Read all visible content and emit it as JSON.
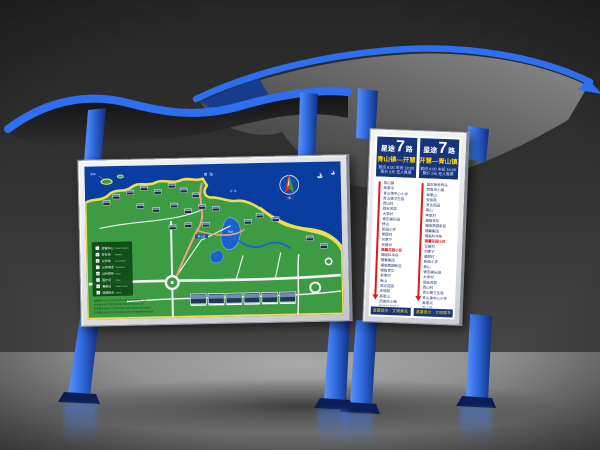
{
  "scene": {
    "accent_blue": "#2e6ff2",
    "post_blue_dark": "#14338c",
    "panel_frame": "#e2e4e8",
    "header_navy": "#17357d",
    "highlight_red": "#e01818",
    "direction_yellow": "#ffd400"
  },
  "map_panel": {
    "sea_label_1": "黄海",
    "sea_label_2": "近海",
    "island_label": "鸥岛",
    "lake_label": "西湖",
    "palace_label": "青山宫",
    "compass_label": "北",
    "legend": {
      "items": [
        {
          "icon": "i",
          "zh": "游客中心",
          "en": "TOURIST CENTER"
        },
        {
          "icon": "P",
          "zh": "停车场",
          "en": "PARKING"
        },
        {
          "icon": "B",
          "zh": "公交站",
          "en": "BUS STATION"
        },
        {
          "icon": "T",
          "zh": "公用电话",
          "en": "TELEPHONE"
        },
        {
          "icon": "WC",
          "zh": "公共厕所",
          "en": "TOILET"
        },
        {
          "icon": "+",
          "zh": "医疗点",
          "en": "CLINIC"
        },
        {
          "icon": "¥",
          "zh": "售票处",
          "en": "TICKET OFFICE"
        },
        {
          "icon": "A",
          "zh": "游船码头",
          "en": "WHARF"
        }
      ]
    },
    "notices": [
      "报警电话 110  TELEPHONE FOR EMERGENCY 110",
      "急救电话 120  TELEPHONE FOR FIRST-AID 120",
      "投诉电话 96301  TELEPHONE FOR COMPLAINT 96301",
      "咨询电话 96110  TELEPHONE FOR INFORMATION 96110"
    ]
  },
  "route_panel": {
    "route_name_prefix": "星途",
    "route_number": "7",
    "route_name_suffix": "路",
    "columns": [
      {
        "direction": "青山镇—开慧",
        "times": "首班 6:00  末班 18:00",
        "fare": "票价 2元  无人售票",
        "footer": "温馨提示 · 文明乘车",
        "highlight": "福馨花园小区",
        "stations": [
          "青山镇",
          "高家屯",
          "青山镇中心小学",
          "青山镇卫生院",
          "西山村",
          "固安风居",
          "大李村",
          "银杏福乐园",
          "移山",
          "新园小学",
          "景颐村",
          "刘家宁",
          "百薇村",
          "福馨花园小区",
          "福临科华所",
          "福馨集团",
          "福临家园新区",
          "福临世华",
          "李家村",
          "南山",
          "滨达花园",
          "安丽苑",
          "高家山",
          "西南风小镇",
          "国生船务码头"
        ]
      },
      {
        "direction": "开慧—青山镇",
        "times": "首班 6:00  末班 18:00",
        "fare": "票价 2元  无人售票",
        "footer": "温馨提示 · 文明乘车",
        "highlight": "福馨花园小区",
        "stations": [
          "国生船务码头",
          "西南风小镇",
          "高家山",
          "安丽苑",
          "滨达花园",
          "南山",
          "李家村",
          "福临世华",
          "福临家园新区",
          "福馨集团",
          "福临科华所",
          "福馨花园小区",
          "百薇村",
          "刘家宁",
          "景颐村",
          "新园小学",
          "移山",
          "银杏福乐园",
          "大李村",
          "固安风居",
          "西山村",
          "青山镇卫生院",
          "青山镇中心小学",
          "高家屯",
          "青山镇"
        ]
      }
    ]
  }
}
